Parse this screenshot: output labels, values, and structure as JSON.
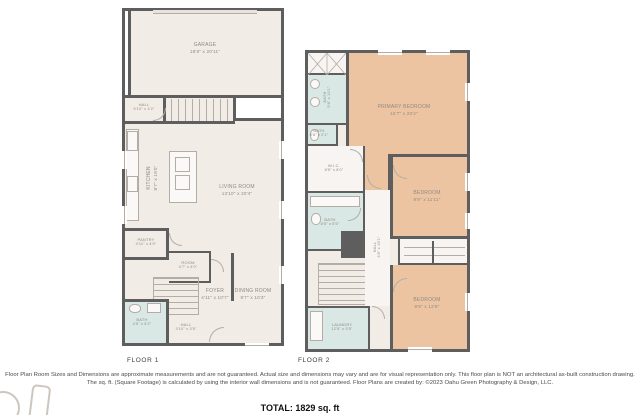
{
  "colors": {
    "wall": "#5e5e5e",
    "floor": "#f2ece7",
    "bedroom": "#edc4a1",
    "bath": "#d9e8e4",
    "room_white": "#f7f4f1",
    "fixture": "#b3ada5",
    "label": "#8f8a85"
  },
  "floor1": {
    "caption": "FLOOR 1",
    "rooms": [
      {
        "name": "GARAGE",
        "dims": "18'8\" x 20'11\""
      },
      {
        "name": "HALL",
        "dims": "5'10\" x 4'2\""
      },
      {
        "name": "KITCHEN",
        "dims": "8'7\" x 19'0\""
      },
      {
        "name": "LIVING ROOM",
        "dims": "13'10\" x 20'4\""
      },
      {
        "name": "PANTRY",
        "dims": "4'11\" x 4'9\""
      },
      {
        "name": "ROOM",
        "dims": "4'7\" x 4'0\""
      },
      {
        "name": "FOYER",
        "dims": "4'11\" x 10'7\""
      },
      {
        "name": "DINING ROOM",
        "dims": "9'7\" x 10'3\""
      },
      {
        "name": "BATH",
        "dims": "4'5\" x 5'2\""
      },
      {
        "name": "HALL",
        "dims": "3'10\" x 3'5\""
      }
    ]
  },
  "floor2": {
    "caption": "FLOOR 2",
    "rooms": [
      {
        "name": "PRIMARY BEDROOM",
        "dims": "15'7\" x 20'2\""
      },
      {
        "name": "BATH",
        "dims": "5'6\" x 10'1\""
      },
      {
        "name": "BATH",
        "dims": "5'8\" x 2'1\""
      },
      {
        "name": "W.I.C.",
        "dims": "8'5\" x 8'0\""
      },
      {
        "name": "BATH",
        "dims": "8'5\" x 5'5\""
      },
      {
        "name": "HALL",
        "dims": "3'6\" x 16'1\""
      },
      {
        "name": "BEDROOM",
        "dims": "9'9\" x 11'11\""
      },
      {
        "name": "BEDROOM",
        "dims": "9'9\" x 12'6\""
      },
      {
        "name": "LAUNDRY",
        "dims": "12'5\" x 5'5\""
      }
    ]
  },
  "footer": {
    "disclaimer_line1": "Floor Plan Room Sizes and Dimensions are approximate measurements and are not guaranteed. Actual size and dimensions may vary and are for visual representation only. This floor plan is NOT an architectural as-built construction drawing.",
    "disclaimer_line2": "The sq. ft. (Square Footage) is calculated by using the interior wall dimensions and is not guaranteed. Floor Plans are created by: ©2023 Oahu Green Photography & Design, LLC.",
    "total": "TOTAL: 1829 sq. ft"
  }
}
